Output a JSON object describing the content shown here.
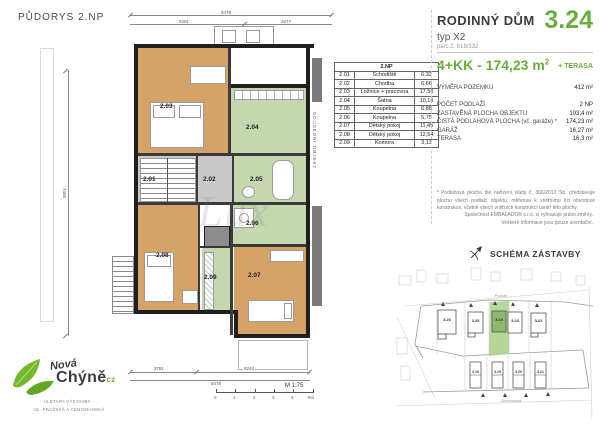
{
  "page_title": "PŮDORYS 2.NP",
  "colors": {
    "accent_green": "#6aaf3d",
    "room_tan": "#d5a267",
    "room_green": "#c4d7af",
    "room_gray": "#c9c9c9"
  },
  "floor_plan": {
    "watermark": "Lux",
    "neighbor_label": "SOUSEDNÍ OBJEKT",
    "rooms": {
      "r201": "2.01",
      "r202": "2.02",
      "r203": "2.03",
      "r204": "2.04",
      "r205": "2.05",
      "r206": "2.06",
      "r207": "2.07",
      "r208": "2.08",
      "r209": "2.09"
    },
    "dimensions": {
      "top_total": "8478",
      "top_left": "5201",
      "top_right": "3277",
      "left": "7455",
      "bottom_left": "3781",
      "bottom_right": "5242",
      "bottom_total": "8478"
    },
    "scale_label": "M 1:75",
    "scale_ticks": [
      "0",
      "1",
      "2",
      "3",
      "4",
      "5m"
    ]
  },
  "room_table": {
    "header": "2.NP",
    "rows": [
      {
        "no": "2.01",
        "name": "Schodiště",
        "area": "6,32"
      },
      {
        "no": "2.02",
        "name": "Chodba",
        "area": "6,66"
      },
      {
        "no": "2.03",
        "name": "Ložnice + pracovna",
        "area": "17,50"
      },
      {
        "no": "2.04",
        "name": "Šatna",
        "area": "10,19"
      },
      {
        "no": "2.05",
        "name": "Koupelna",
        "area": "6,88"
      },
      {
        "no": "2.06",
        "name": "Koupelna",
        "area": "5,75"
      },
      {
        "no": "2.07",
        "name": "Dětský pokoj",
        "area": "11,45"
      },
      {
        "no": "2.08",
        "name": "Dětský pokoj",
        "area": "12,54"
      },
      {
        "no": "2.09",
        "name": "Komora",
        "area": "3,13"
      }
    ]
  },
  "info_panel": {
    "title": "RODINNÝ DŮM",
    "subtitle": "typ X2",
    "unit_number": "3.24",
    "parcel": "parc.č. 616/332",
    "disposition": "4+KK - 174,23 m",
    "disposition_sup": "2",
    "terrace_badge": "+ TERASA",
    "specs": [
      {
        "label": "VÝMĚRA POZEMKU",
        "value": "412 m²"
      },
      {
        "label": "POČET PODLAŽÍ",
        "value": "2 NP"
      },
      {
        "label": "ZASTAVĚNÁ PLOCHA OBJEKTU",
        "value": "103,4 m²"
      },
      {
        "label": "ČISTÁ PODLAHOVÁ PLOCHA (vč. garáže) *",
        "value": "174,23 m²"
      },
      {
        "label": "GARÁŽ",
        "value": "16,27 m²"
      },
      {
        "label": "TERASA",
        "value": "16,3 m²"
      }
    ],
    "footnote_mark": "*",
    "footnote": "Podlahová plocha dle nařízení vlády č. 366/2013 Sb. představuje plochu všech podlaží objektu, měřenou k vnitřnímu líci obvodové konstrukce, včetně všech vnitřních konstrukcí uvnitř této plochy.",
    "disclaimer_line1": "Společnost EMBALADOR s.r.o. si vyhrazuje právo změny.",
    "disclaimer_line2": "Veškeré informace jsou pouze orientační."
  },
  "site_plan": {
    "title": "SCHÉMA ZÁSTAVBY",
    "street_top": "Pražská",
    "street_bottom": "Cenomanská",
    "houses_top": [
      "3.26",
      "3.25",
      "3.24",
      "3.23",
      "3.22"
    ],
    "houses_bottom": [
      "3.18",
      "3.19",
      "3.20",
      "3.21"
    ],
    "highlighted_house": "3.24"
  },
  "logo": {
    "name_line1": "Nová",
    "name_line2": "Chýně",
    "name_suffix": "cz",
    "tagline_line1": "III.ETAPA VÝSTAVBY -",
    "tagline_line2": "UL. PRAŽSKÁ A CENOMANSKÁ"
  }
}
